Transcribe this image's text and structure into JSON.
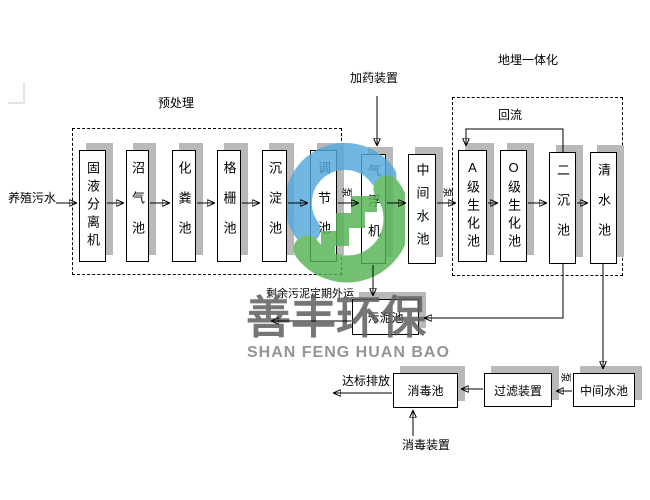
{
  "diagram": {
    "input_label": "养殖污水",
    "groups": {
      "pretreatment": {
        "label": "预处理"
      },
      "underground_integrated": {
        "label": "地埋一体化"
      }
    },
    "tanks": {
      "solid_liquid_separator": "固液分离机",
      "biogas_tank": "沼气池",
      "septic_tank": "化粪池",
      "grid_tank": "格栅池",
      "sedimentation_tank": "沉淀池",
      "regulating_tank": "调节池",
      "air_flotation_machine": "气浮机",
      "intermediate_tank_1": "中间水池",
      "a_level_bio_tank": "A级生化池",
      "o_level_bio_tank": "O级生化池",
      "secondary_sedimentation_tank": "二沉池",
      "clean_water_tank": "清水池",
      "sludge_tank": "污泥池",
      "disinfection_tank": "消毒池",
      "filter_device": "过滤装置",
      "intermediate_tank_2": "中间水池"
    },
    "annotations": {
      "dosing_device": "加药装置",
      "reflux": "回流",
      "pump": "泵",
      "sludge_removal": "剩余污泥定期外运",
      "discharge": "达标排放",
      "disinfection_device": "消毒装置"
    }
  },
  "watermark": {
    "company_cn": "善丰环保",
    "company_en": "SHAN FENG HUAN BAO",
    "logo_blue": "#54a8dc",
    "logo_green": "#55b355",
    "text_color": "#5f5f5f",
    "shadow_gray": "#b9b9b9"
  }
}
